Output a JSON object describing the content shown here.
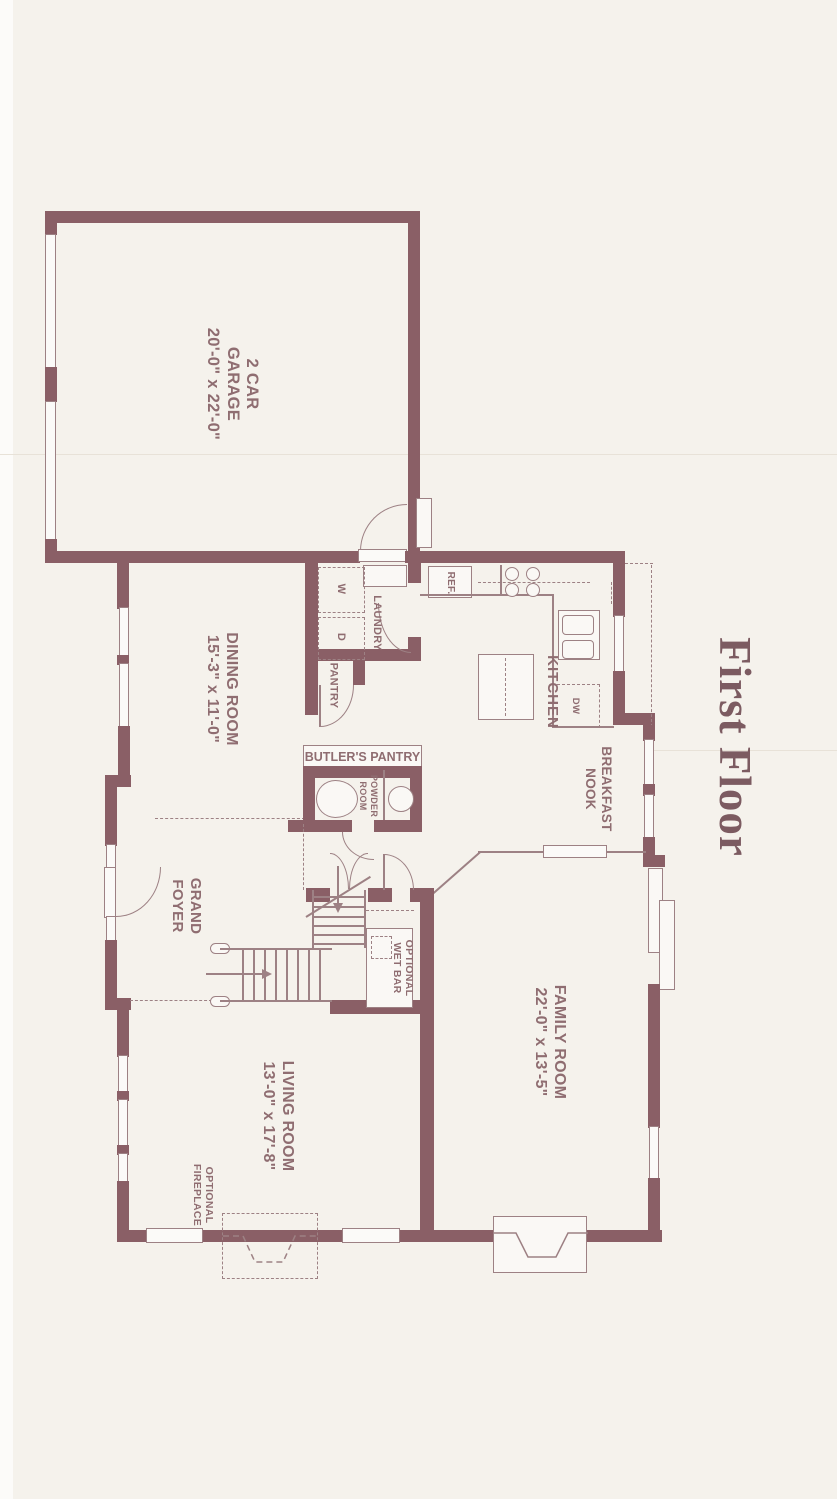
{
  "title": "First Floor",
  "colors": {
    "background": "#f5f2ec",
    "wall": "#8a5f66",
    "thin_line": "#9d8184",
    "label_text": "#8f6d71",
    "title_text": "#7c5b61"
  },
  "rooms": {
    "garage": {
      "line1": "2 CAR",
      "line2": "GARAGE",
      "dims": "20'-0\" x 22'-0\""
    },
    "dining": {
      "line1": "DINING ROOM",
      "dims": "15'-3\" x 11'-0\""
    },
    "kitchen": {
      "line1": "KITCHEN"
    },
    "laundry": {
      "line1": "LAUNDRY"
    },
    "pantry": {
      "line1": "PANTRY"
    },
    "butlers": {
      "line1": "BUTLER'S PANTRY"
    },
    "powder": {
      "line1": "POWDER",
      "line2": "ROOM"
    },
    "breakfast": {
      "line1": "BREAKFAST",
      "line2": "NOOK"
    },
    "foyer": {
      "line1": "GRAND",
      "line2": "FOYER"
    },
    "family": {
      "line1": "FAMILY ROOM",
      "dims": "22'-0\" x 13'-5\""
    },
    "living": {
      "line1": "LIVING ROOM",
      "dims": "13'-0\" x 17'-8\""
    },
    "wetbar": {
      "line1": "OPTIONAL",
      "line2": "WET BAR"
    },
    "optional_fireplace": {
      "line1": "OPTIONAL",
      "line2": "FIREPLACE"
    }
  },
  "appliances": {
    "washer": "W",
    "dryer": "D",
    "refrigerator": "REF.",
    "dishwasher": "DW"
  }
}
